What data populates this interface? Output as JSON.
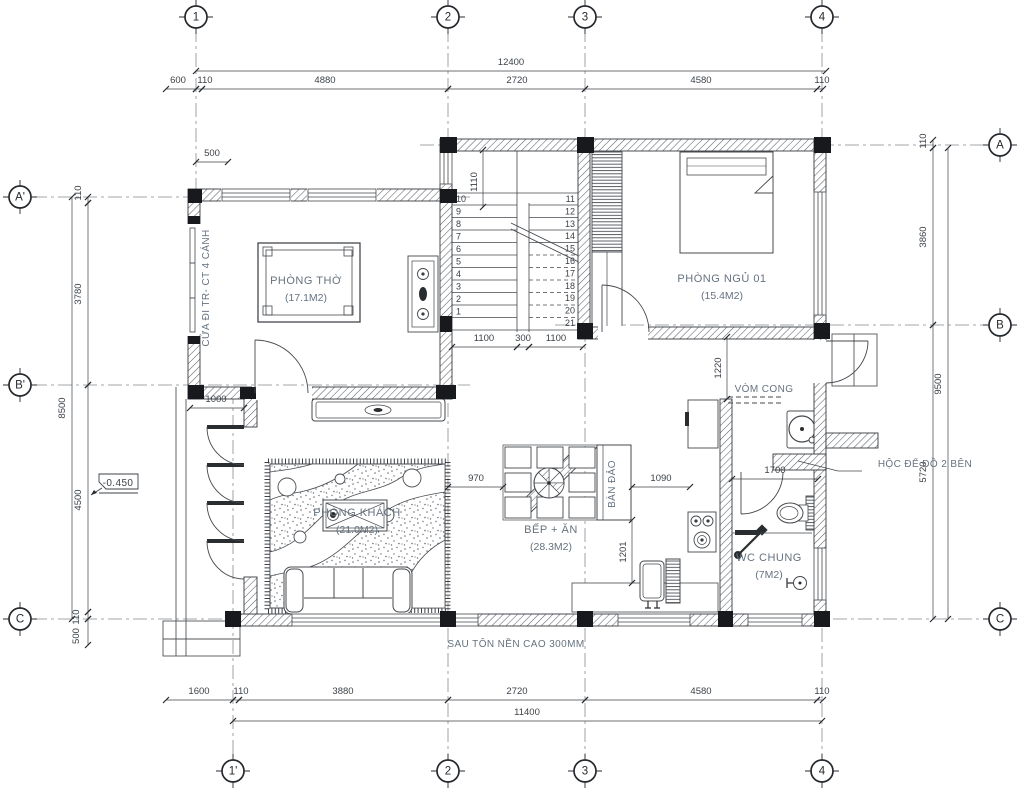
{
  "drawing": {
    "bg": "#ffffff",
    "line_color": "#44484d",
    "wall_edge": "#35393e",
    "column_color": "#17191c",
    "label_color": "#66727f",
    "dim_color": "#3c4249",
    "bubble_color": "#25292e"
  },
  "grid_bubbles": [
    {
      "label": "1",
      "x": 196,
      "y": 17
    },
    {
      "label": "2",
      "x": 448,
      "y": 17
    },
    {
      "label": "3",
      "x": 585,
      "y": 17
    },
    {
      "label": "4",
      "x": 822,
      "y": 17
    },
    {
      "label": "1'",
      "x": 233,
      "y": 771
    },
    {
      "label": "2",
      "x": 448,
      "y": 771
    },
    {
      "label": "3",
      "x": 585,
      "y": 771
    },
    {
      "label": "4",
      "x": 822,
      "y": 771
    },
    {
      "label": "A'",
      "x": 20,
      "y": 197
    },
    {
      "label": "B'",
      "x": 20,
      "y": 385
    },
    {
      "label": "C",
      "x": 20,
      "y": 619
    },
    {
      "label": "A",
      "x": 1000,
      "y": 145
    },
    {
      "label": "B",
      "x": 1000,
      "y": 325
    },
    {
      "label": "C",
      "x": 1000,
      "y": 619
    }
  ],
  "room_labels": [
    {
      "name": "PHÒNG THỜ",
      "area": "(17.1M2)",
      "x": 306,
      "y": 284
    },
    {
      "name": "PHÒNG NGỦ 01",
      "area": "(15.4M2)",
      "x": 722,
      "y": 282
    },
    {
      "name": "PHÒNG KHÁCH",
      "area": "(21.0M2)",
      "x": 357,
      "y": 516
    },
    {
      "name": "BẾP + ĂN",
      "area": "(28.3M2)",
      "x": 551,
      "y": 533
    },
    {
      "name": "WC CHUNG",
      "area": "(7M2)",
      "x": 769,
      "y": 561
    }
  ],
  "annotations": [
    {
      "text": "CỬA ĐI TR- CT 4 CÁNH",
      "x": 209,
      "y": 288,
      "rot": -90
    },
    {
      "text": "BÀN ĐẢO",
      "x": 615,
      "y": 484,
      "rot": -90
    },
    {
      "text": "VÒM CONG",
      "x": 764,
      "y": 392,
      "rot": 0
    },
    {
      "text": "HỘC ĐỂ ĐỒ 2 BÊN",
      "x": 925,
      "y": 467,
      "rot": 0
    },
    {
      "text": "SAU TÔN NỀN CAO 300MM",
      "x": 516,
      "y": 647,
      "rot": 0
    },
    {
      "text": "-0.450",
      "x": 118,
      "y": 486,
      "rot": 0,
      "flag": true
    }
  ],
  "dimensions": [
    {
      "t": "12400",
      "x1": 196,
      "y1": 71,
      "x2": 826,
      "y2": 71,
      "tx": 511,
      "ty": 65
    },
    {
      "t": "600",
      "x1": 166,
      "y1": 89,
      "x2": 196,
      "y2": 89,
      "tx": 178,
      "ty": 83
    },
    {
      "t": "110",
      "x1": 196,
      "y1": 89,
      "x2": 202,
      "y2": 89,
      "tx": 205,
      "ty": 83
    },
    {
      "t": "4880",
      "x1": 202,
      "y1": 89,
      "x2": 448,
      "y2": 89,
      "tx": 325,
      "ty": 83
    },
    {
      "t": "2720",
      "x1": 448,
      "y1": 89,
      "x2": 585,
      "y2": 89,
      "tx": 517,
      "ty": 83
    },
    {
      "t": "4580",
      "x1": 585,
      "y1": 89,
      "x2": 817,
      "y2": 89,
      "tx": 701,
      "ty": 83
    },
    {
      "t": "110",
      "x1": 817,
      "y1": 89,
      "x2": 823,
      "y2": 89,
      "tx": 822,
      "ty": 83
    },
    {
      "t": "1600",
      "x1": 166,
      "y1": 700,
      "x2": 233,
      "y2": 700,
      "tx": 199,
      "ty": 694
    },
    {
      "t": "110",
      "x1": 233,
      "y1": 700,
      "x2": 239,
      "y2": 700,
      "tx": 241,
      "ty": 694
    },
    {
      "t": "3880",
      "x1": 239,
      "y1": 700,
      "x2": 448,
      "y2": 700,
      "tx": 343,
      "ty": 694
    },
    {
      "t": "2720",
      "x1": 448,
      "y1": 700,
      "x2": 585,
      "y2": 700,
      "tx": 517,
      "ty": 694
    },
    {
      "t": "4580",
      "x1": 585,
      "y1": 700,
      "x2": 817,
      "y2": 700,
      "tx": 701,
      "ty": 694
    },
    {
      "t": "110",
      "x1": 817,
      "y1": 700,
      "x2": 823,
      "y2": 700,
      "tx": 822,
      "ty": 694
    },
    {
      "t": "11400",
      "x1": 233,
      "y1": 721,
      "x2": 822,
      "y2": 721,
      "tx": 527,
      "ty": 715
    },
    {
      "t": "110",
      "x1": 88,
      "y1": 197,
      "x2": 88,
      "y2": 203,
      "tx": 81,
      "ty": 193,
      "rot": -90
    },
    {
      "t": "3780",
      "x1": 88,
      "y1": 203,
      "x2": 88,
      "y2": 385,
      "tx": 81,
      "ty": 294,
      "rot": -90
    },
    {
      "t": "4500",
      "x1": 88,
      "y1": 385,
      "x2": 88,
      "y2": 612,
      "tx": 81,
      "ty": 500,
      "rot": -90
    },
    {
      "t": "110",
      "x1": 88,
      "y1": 612,
      "x2": 88,
      "y2": 619,
      "tx": 79,
      "ty": 617,
      "rot": -90
    },
    {
      "t": "500",
      "x1": 88,
      "y1": 619,
      "x2": 88,
      "y2": 645,
      "tx": 79,
      "ty": 636,
      "rot": -90
    },
    {
      "t": "8500",
      "x1": 72,
      "y1": 197,
      "x2": 72,
      "y2": 619,
      "tx": 65,
      "ty": 408,
      "rot": -90
    },
    {
      "t": "110",
      "x1": 933,
      "y1": 140,
      "x2": 933,
      "y2": 148,
      "tx": 926,
      "ty": 141,
      "rot": -90
    },
    {
      "t": "3860",
      "x1": 933,
      "y1": 148,
      "x2": 933,
      "y2": 325,
      "tx": 926,
      "ty": 237,
      "rot": -90
    },
    {
      "t": "5720",
      "x1": 933,
      "y1": 325,
      "x2": 933,
      "y2": 619,
      "tx": 926,
      "ty": 472,
      "rot": -90
    },
    {
      "t": "9500",
      "x1": 948,
      "y1": 148,
      "x2": 948,
      "y2": 619,
      "tx": 941,
      "ty": 384,
      "rot": -90
    },
    {
      "t": "500",
      "x1": 196,
      "y1": 162,
      "x2": 228,
      "y2": 162,
      "tx": 212,
      "ty": 156
    },
    {
      "t": "1110",
      "x1": 483,
      "y1": 150,
      "x2": 483,
      "y2": 207,
      "tx": 477,
      "ty": 182,
      "rot": -90
    },
    {
      "t": "1100",
      "x1": 452,
      "y1": 347,
      "x2": 517,
      "y2": 347,
      "tx": 484,
      "ty": 341
    },
    {
      "t": "300",
      "x1": 517,
      "y1": 347,
      "x2": 529,
      "y2": 347,
      "tx": 523,
      "ty": 341
    },
    {
      "t": "1100",
      "x1": 529,
      "y1": 347,
      "x2": 583,
      "y2": 347,
      "tx": 556,
      "ty": 341
    },
    {
      "t": "1000",
      "x1": 190,
      "y1": 408,
      "x2": 244,
      "y2": 408,
      "tx": 216,
      "ty": 402
    },
    {
      "t": "970",
      "x1": 448,
      "y1": 487,
      "x2": 503,
      "y2": 487,
      "tx": 476,
      "ty": 481
    },
    {
      "t": "1090",
      "x1": 632,
      "y1": 487,
      "x2": 690,
      "y2": 487,
      "tx": 661,
      "ty": 481
    },
    {
      "t": "1201",
      "x1": 632,
      "y1": 520,
      "x2": 632,
      "y2": 583,
      "tx": 626,
      "ty": 552,
      "rot": -90
    },
    {
      "t": "1220",
      "x1": 727,
      "y1": 337,
      "x2": 727,
      "y2": 399,
      "tx": 721,
      "ty": 368,
      "rot": -90
    },
    {
      "t": "1700",
      "x1": 732,
      "y1": 479,
      "x2": 818,
      "y2": 479,
      "tx": 775,
      "ty": 473
    }
  ],
  "stairs": {
    "left_numbers": [
      "10",
      "9",
      "8",
      "7",
      "6",
      "5",
      "4",
      "3",
      "2",
      "1"
    ],
    "right_numbers": [
      "11",
      "12",
      "13",
      "14",
      "15",
      "16",
      "17",
      "18",
      "19",
      "20",
      "21"
    ]
  }
}
